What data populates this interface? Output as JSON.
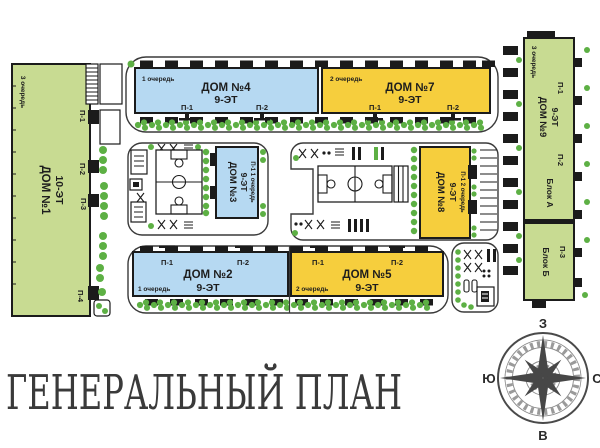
{
  "title": "ГЕНЕРАЛЬНЫЙ ПЛАН",
  "colors": {
    "green": "#c8db92",
    "blue": "#b6d9f2",
    "yellow": "#f6ce3d",
    "tree_green": "#5db044",
    "outline": "#1b1b1b"
  },
  "compass": {
    "top": "З",
    "right": "С",
    "bottom": "В",
    "left": "Ю"
  },
  "houses": {
    "dom1": {
      "name": "ДОМ №1",
      "floors": "10-ЭТ",
      "phase": "3 очередь",
      "e1": "П-1",
      "e2": "П-2",
      "e3": "П-3",
      "e4": "П-4"
    },
    "dom2": {
      "name": "ДОМ №2",
      "floors": "9-ЭТ",
      "phase": "1 очередь",
      "e1": "П-1",
      "e2": "П-2"
    },
    "dom3": {
      "name": "ДОМ №3",
      "floors": "9-ЭТ",
      "phase": "П-1 1 очередь"
    },
    "dom4": {
      "name": "ДОМ №4",
      "floors": "9-ЭТ",
      "phase": "1 очередь",
      "e1": "П-1",
      "e2": "П-2"
    },
    "dom5": {
      "name": "ДОМ №5",
      "floors": "9-ЭТ",
      "phase": "2 очередь",
      "e1": "П-1",
      "e2": "П-2"
    },
    "dom7": {
      "name": "ДОМ №7",
      "floors": "9-ЭТ",
      "phase": "2 очередь",
      "e1": "П-1",
      "e2": "П-2"
    },
    "dom8": {
      "name": "ДОМ №8",
      "floors": "9-ЭТ",
      "phase": "П-1 2 очередь"
    },
    "dom9": {
      "name": "ДОМ №9",
      "floors": "9-ЭТ",
      "phase": "3 очередь",
      "e1": "П-1",
      "e2": "П-2",
      "e3": "П-3",
      "block_a": "Блок А",
      "block_b": "Блок Б"
    }
  }
}
